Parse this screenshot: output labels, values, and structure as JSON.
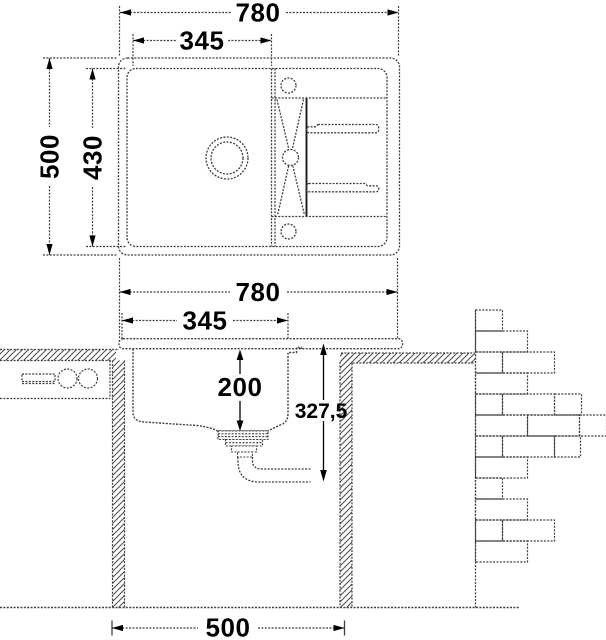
{
  "top_view": {
    "dim_width": "780",
    "dim_bowl_width": "345",
    "dim_height": "500",
    "dim_inner_height": "430"
  },
  "cross_section": {
    "dim_width": "780",
    "dim_bowl_width": "345",
    "dim_bowl_depth": "200",
    "dim_total_depth": "327,5",
    "dim_cabinet_width": "500"
  },
  "colors": {
    "line_color": "#3f3f3f",
    "text_color": "#000000",
    "background": "#ffffff"
  }
}
